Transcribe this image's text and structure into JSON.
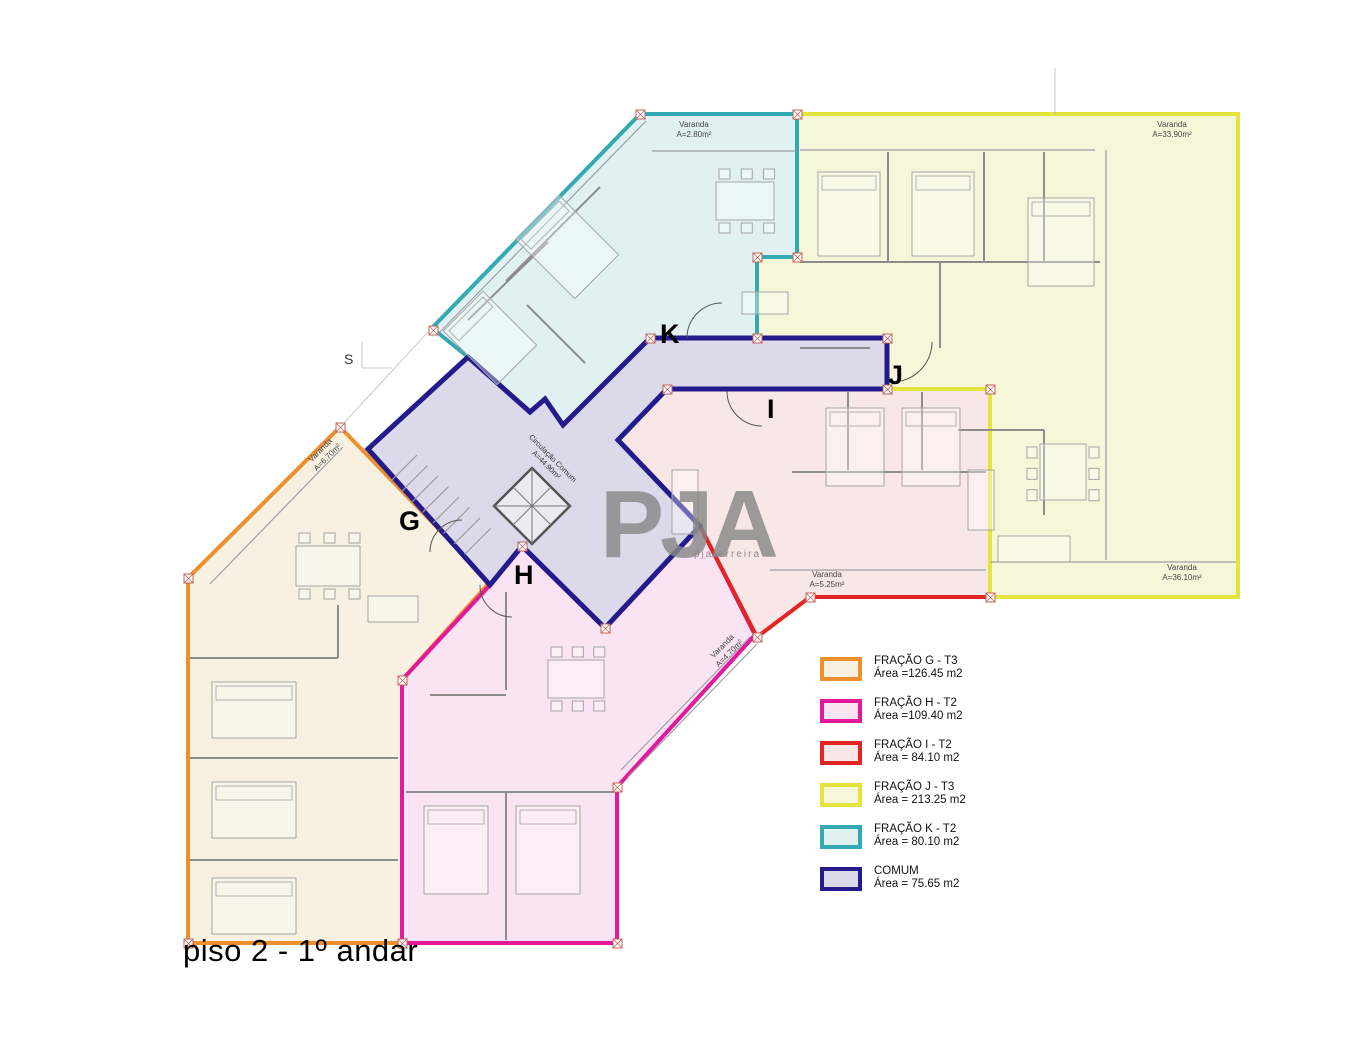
{
  "title": "piso 2 - 1º andar",
  "section_marker": "S",
  "watermark": {
    "text": "PJA",
    "subtext": "pjaferreira"
  },
  "circulation_label": {
    "line1": "Circulação Comum",
    "line2": "A=44.90m²"
  },
  "legend_title_suffix": "",
  "fractions": [
    {
      "id": "G",
      "letter": "G",
      "legend_label": "FRAÇÃO G - T3",
      "legend_area": "Área =126.45 m2",
      "stroke": "#ee8f2d",
      "fill": "#f8f0e0",
      "points": "340,427 490,582 402,680 402,943 188,943 188,578",
      "letter_x": 399,
      "letter_y": 530,
      "varandas": [
        {
          "lines": [
            "Varanda",
            "A=6.70m²"
          ],
          "x": 322,
          "y": 452,
          "rotate": -45
        }
      ]
    },
    {
      "id": "H",
      "letter": "H",
      "legend_label": "FRAÇÃO H - T2",
      "legend_area": "Área =109.40 m2",
      "stroke": "#e3189c",
      "fill": "#fae3f2",
      "points": "490,585 522,547 605,628 700,526 755,635 617,787 617,943 402,943 402,680",
      "letter_x": 514,
      "letter_y": 584,
      "varandas": [
        {
          "lines": [
            "Varanda",
            "A=4.70m²"
          ],
          "x": 724,
          "y": 648,
          "rotate": -45
        }
      ]
    },
    {
      "id": "I",
      "letter": "I",
      "legend_label": "FRAÇÃO I - T2",
      "legend_area": "Área = 84.10 m2",
      "stroke": "#e32422",
      "fill": "#f9e7e7",
      "points": "667,389 990,389 990,597 810,597 757,637 700,526 618,440",
      "letter_x": 767,
      "letter_y": 418,
      "varandas": [
        {
          "lines": [
            "Varanda",
            "A=5.25m²"
          ],
          "x": 827,
          "y": 577,
          "rotate": 0
        }
      ]
    },
    {
      "id": "J",
      "letter": "J",
      "legend_label": "FRAÇÃO J - T3",
      "legend_area": "Área = 213.25 m2",
      "stroke": "#e3e53e",
      "fill": "#f6f7d9",
      "points": "797,114 1238,114 1238,597 990,597 990,389 887,389 887,338 757,338 757,257 797,257",
      "letter_x": 888,
      "letter_y": 384,
      "varandas": [
        {
          "lines": [
            "Varanda",
            "A=33.90m²"
          ],
          "x": 1172,
          "y": 127,
          "rotate": 0
        },
        {
          "lines": [
            "Varanda",
            "A=36.10m²"
          ],
          "x": 1182,
          "y": 570,
          "rotate": 0
        }
      ]
    },
    {
      "id": "K",
      "letter": "K",
      "legend_label": "FRAÇÃO K - T2",
      "legend_area": "Área = 80.10 m2",
      "stroke": "#33a9b3",
      "fill": "#e1f1f2",
      "points": "640,114 797,114 797,257 757,257 757,338 650,338 563,425 545,399 530,412 468,357 432,328",
      "letter_x": 660,
      "letter_y": 343,
      "varandas": [
        {
          "lines": [
            "Varanda",
            "A=2.80m²"
          ],
          "x": 694,
          "y": 127,
          "rotate": 0
        }
      ]
    },
    {
      "id": "COMUM",
      "letter": "",
      "legend_label": "COMUM",
      "legend_area": "Área = 75.65 m2",
      "stroke": "#241a8c",
      "fill": "#dcdaea",
      "points": "468,357 530,412 545,399 563,425 650,338 887,338 887,389 667,389 618,440 700,526 605,628 522,546 490,585 368,449",
      "letter_x": 0,
      "letter_y": 0,
      "varandas": []
    }
  ]
}
